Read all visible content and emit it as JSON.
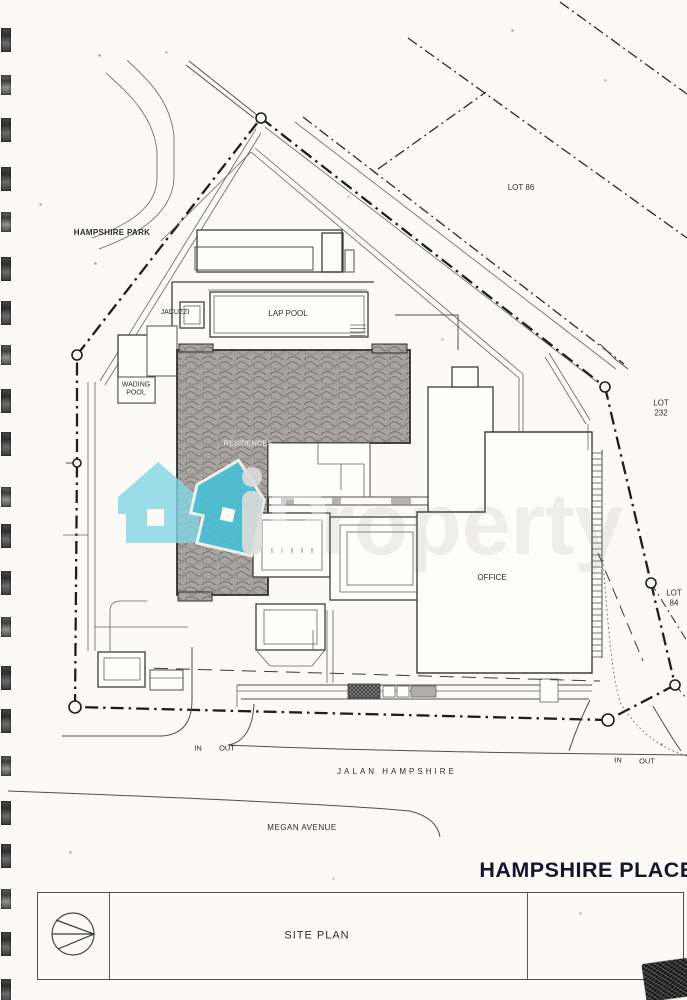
{
  "document": {
    "project_title": "HAMPSHIRE PLACE",
    "drawing_title": "SITE PLAN"
  },
  "plan": {
    "areas": {
      "hampshire_park": "HAMPSHIRE PARK",
      "lot_86": "LOT 86",
      "lot_232": {
        "line1": "LOT",
        "line2": "232"
      },
      "lot_84": {
        "line1": "LOT",
        "line2": "84"
      }
    },
    "facilities": {
      "jacuzzi": "JACUZZI",
      "lap_pool": "LAP POOL",
      "wading_pool": {
        "line1": "WADING",
        "line2": "POOL"
      },
      "residences": "RESIDENCES",
      "office": "OFFICE"
    },
    "roads": {
      "jalan_hampshire": "JALAN HAMPSHIRE",
      "megan_avenue": "MEGAN AVENUE"
    },
    "access": {
      "west_in": "IN",
      "west_out": "OUT",
      "east_in": "IN",
      "east_out": "OUT"
    }
  },
  "watermark": {
    "letter_i": "i",
    "letter_p": "P",
    "ghost_letters": "roperty",
    "house_light_color": "#82d5e4",
    "house_dark_color": "#47c0d8"
  },
  "colors": {
    "paper": "#fbfaf7",
    "ink": "#2d2d2d"
  }
}
